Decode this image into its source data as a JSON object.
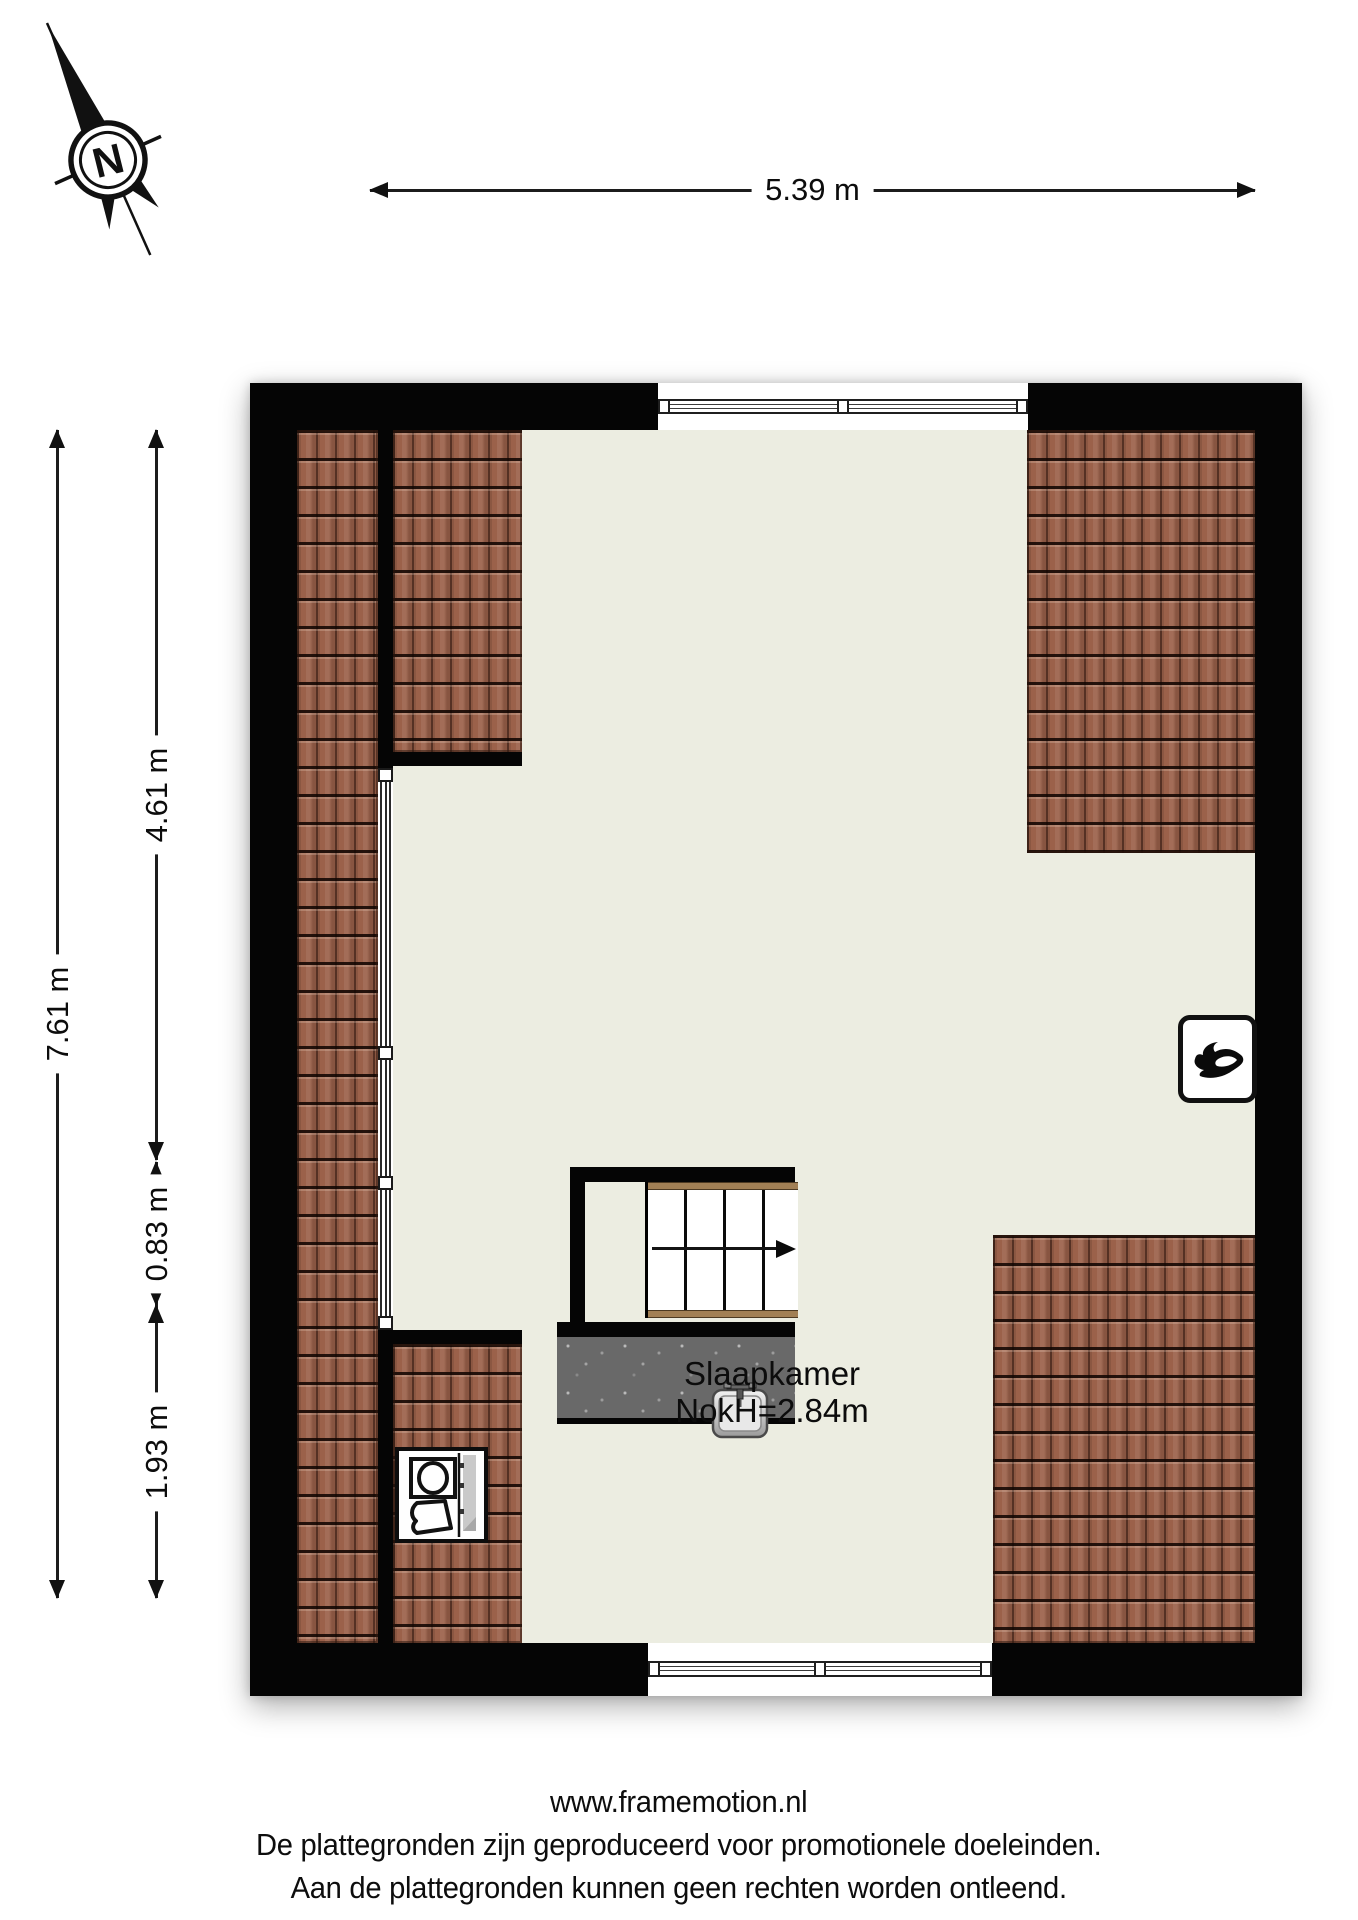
{
  "compass": {
    "label": "N"
  },
  "dimensions": {
    "top": "5.39 m",
    "left_total": "7.61 m",
    "left_segments": [
      "4.61 m",
      "0.83 m",
      "1.93 m"
    ]
  },
  "room": {
    "name": "Slaapkamer",
    "ridge_height": "NokH=2.84m"
  },
  "footer": {
    "line1": "www.framemotion.nl",
    "line2": "De plattegronden zijn geproduceerd voor promotionele doeleinden.",
    "line3": "Aan de plattegronden kunnen geen rechten worden ontleend."
  },
  "colors": {
    "wall": "#050505",
    "floor": "#ecede1",
    "roof_tile": "#9b614a",
    "landing": "#696969",
    "stair_trim": "#a28055"
  },
  "icons": {
    "compass": "north-compass-icon",
    "heater": "flame-icon",
    "washer": "washing-machine-icon",
    "sink": "sink-icon",
    "stairs": "stairs-direction-arrow-icon"
  }
}
